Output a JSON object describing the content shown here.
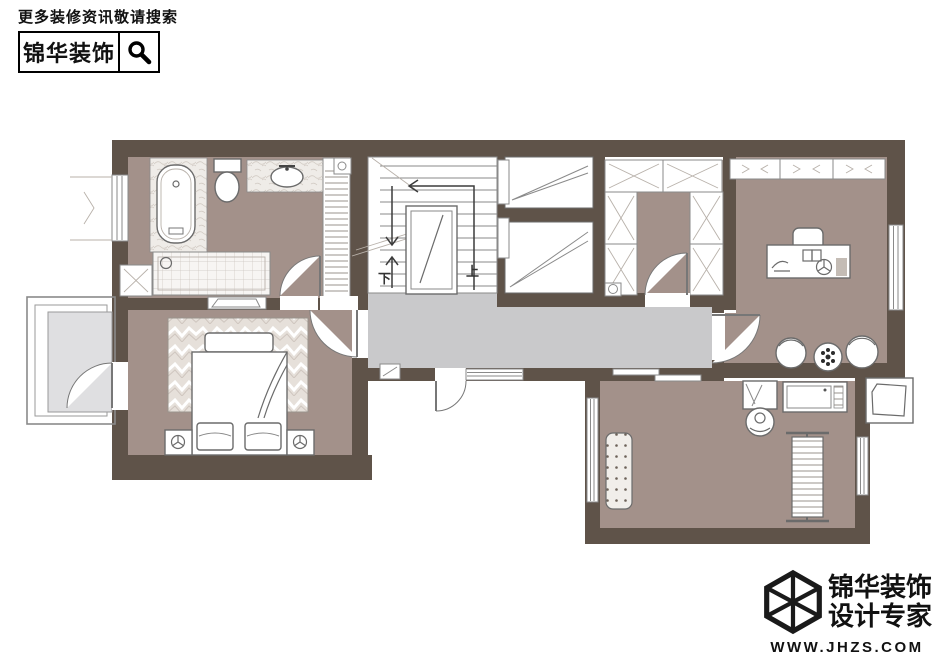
{
  "header": {
    "tagline": "更多装修资讯敬请搜索",
    "brand": "锦华装饰",
    "search_icon": "magnifier"
  },
  "floorplan": {
    "stairs": {
      "up_label": "上",
      "down_label": "下"
    },
    "colors": {
      "wall": "#5f5349",
      "floor": "#a3918a",
      "corridor": "#c9c9cb",
      "balcony": "#dfdfe1",
      "ink": "#111111"
    }
  },
  "footer": {
    "logo_icon": "cube-wireframe",
    "brand": "锦华装饰",
    "tagline": "设计专家",
    "url": "WWW.JHZS.COM"
  }
}
